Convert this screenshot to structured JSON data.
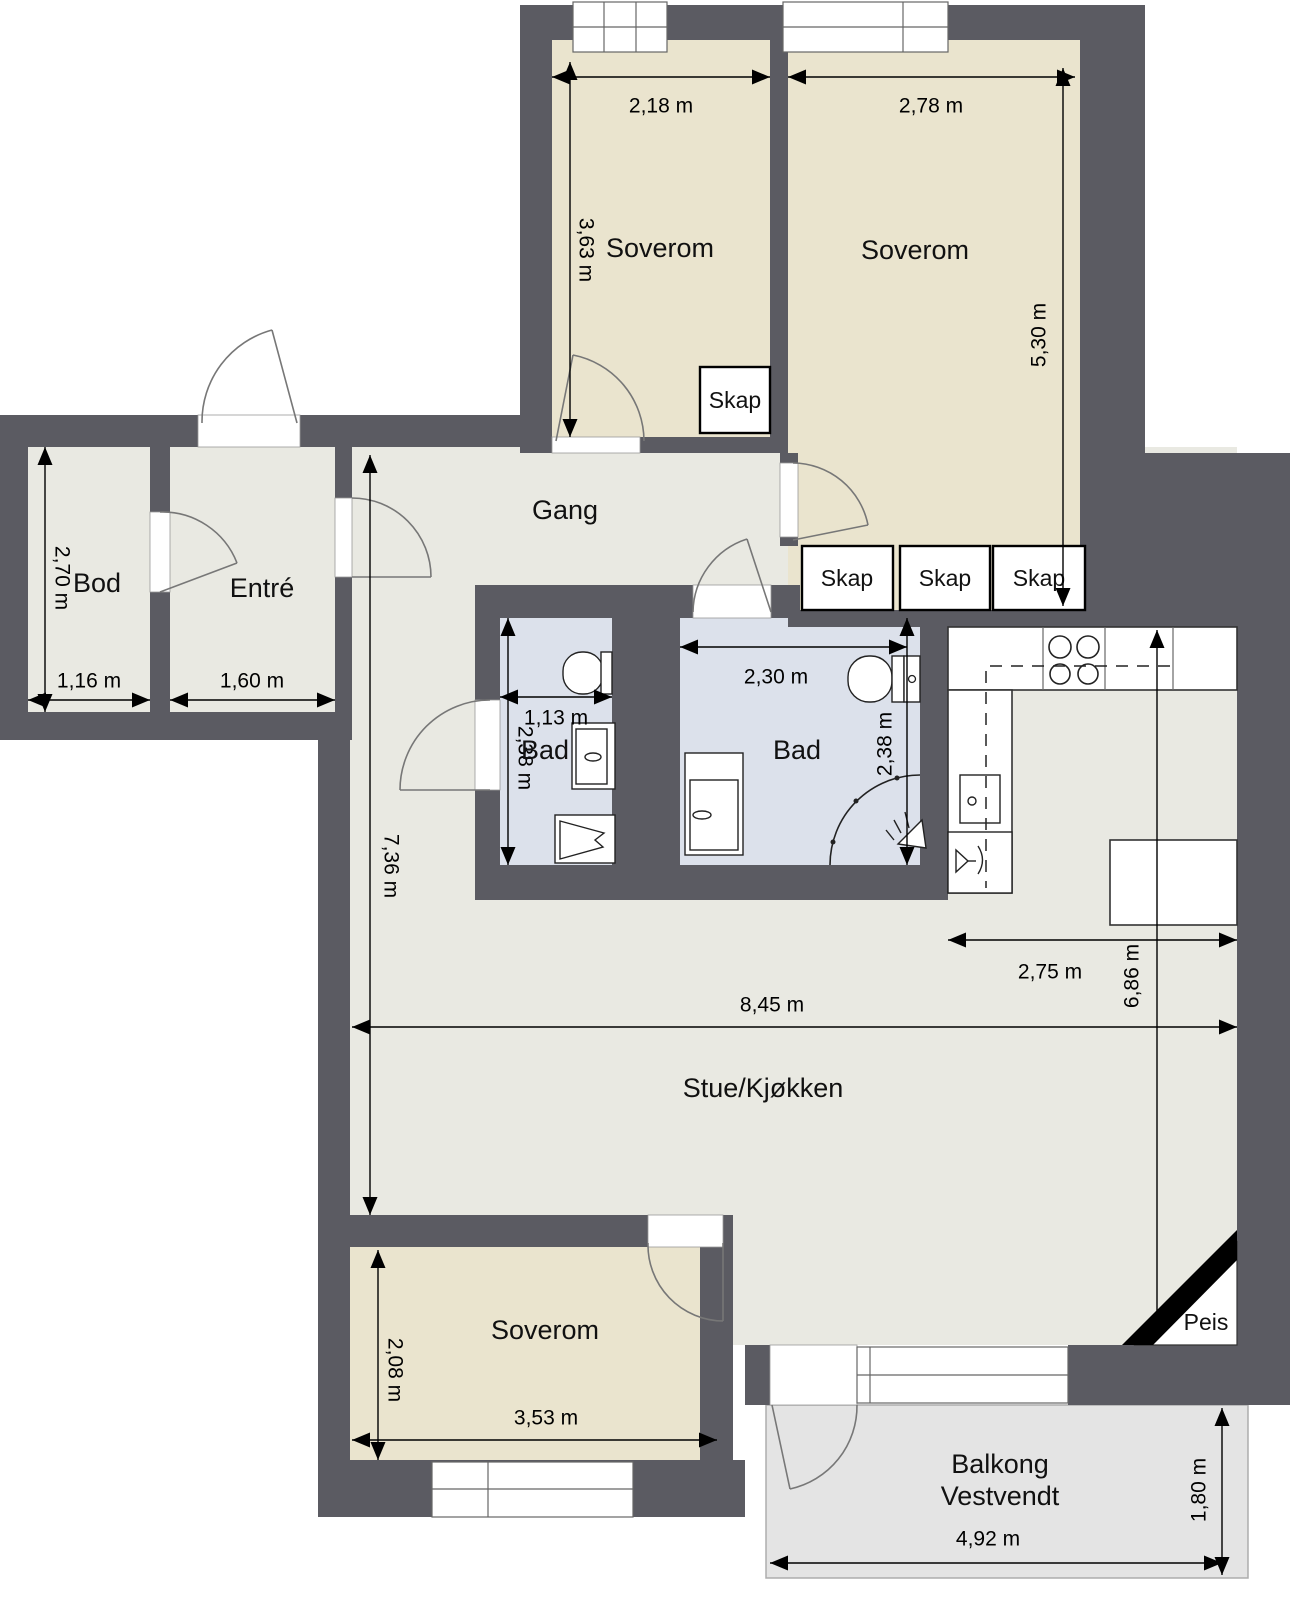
{
  "colors": {
    "wall": "#5b5b62",
    "bedroom": "#eae4ce",
    "living": "#e9e9e2",
    "bath": "#dce1eb",
    "balcony": "#e4e4e4"
  },
  "rooms": {
    "soverom_top_left": {
      "label": "Soverom",
      "width": "2,18 m",
      "height": "3,63 m"
    },
    "soverom_top_right": {
      "label": "Soverom",
      "width": "2,78 m",
      "height": "5,30 m"
    },
    "gang": {
      "label": "Gang"
    },
    "bod": {
      "label": "Bod",
      "width": "1,16 m",
      "height": "2,70 m"
    },
    "entre": {
      "label": "Entré",
      "width": "1,60 m"
    },
    "bad_small": {
      "label": "Bad",
      "width": "1,13 m",
      "height": "2,38 m"
    },
    "bad_large": {
      "label": "Bad",
      "width": "2,30 m",
      "height": "2,38 m"
    },
    "stue_kjokken": {
      "label": "Stue/Kjøkken",
      "width": "8,45 m",
      "height": "7,36 m"
    },
    "kjokken": {
      "width": "2,75 m",
      "height": "6,86 m"
    },
    "soverom_bottom": {
      "label": "Soverom",
      "width": "3,53 m",
      "height": "2,08 m"
    },
    "balkong": {
      "label_line1": "Balkong",
      "label_line2": "Vestvendt",
      "width": "4,92 m",
      "height": "1,80 m"
    },
    "peis": {
      "label": "Peis"
    }
  },
  "closets": [
    {
      "label": "Skap"
    },
    {
      "label": "Skap"
    },
    {
      "label": "Skap"
    },
    {
      "label": "Skap"
    }
  ]
}
